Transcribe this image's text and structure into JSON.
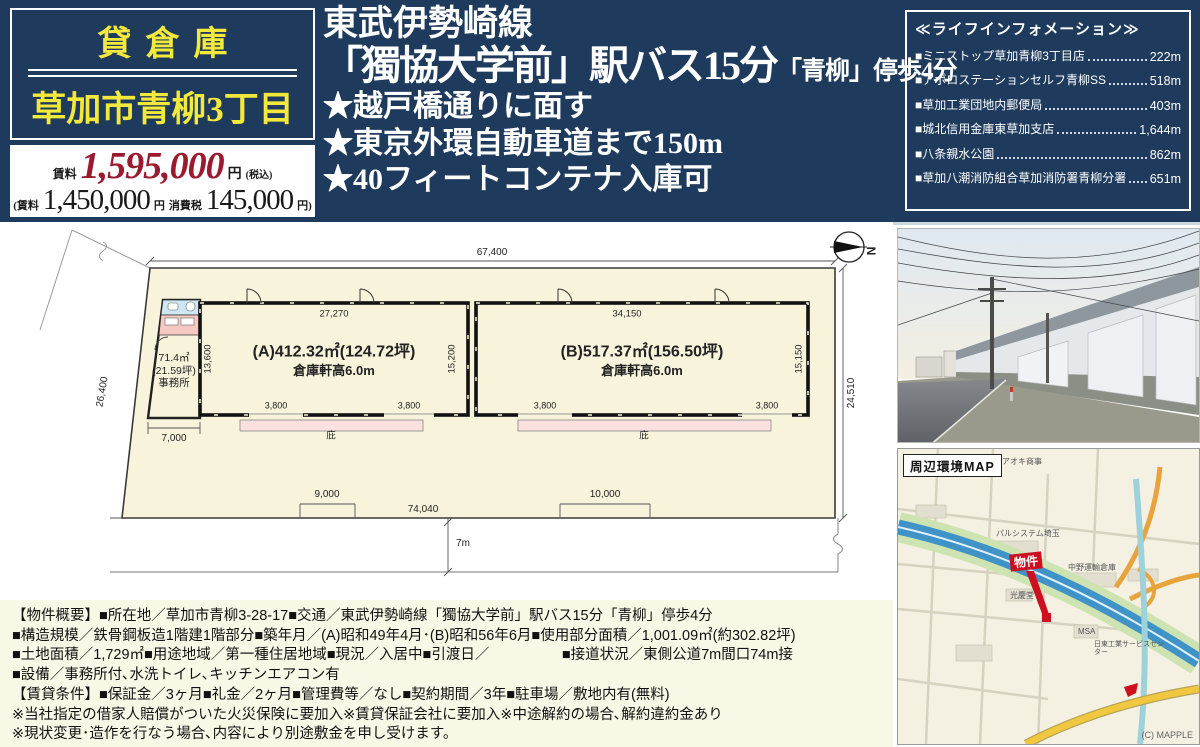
{
  "header": {
    "badge": "貸倉庫",
    "title": "草加市青柳3丁目",
    "price": {
      "label": "賃料",
      "amount": "1,595,000",
      "unit": "円",
      "tax_note": "(税込)",
      "detail_open": "(賃料",
      "base": "1,450,000",
      "base_unit": "円",
      "tax_label": "消費税",
      "tax": "145,000",
      "tax_unit": "円)"
    },
    "line1": "東武伊勢崎線",
    "line2_main": "「獨協大学前」駅バス15分",
    "line2_sub": "「青柳」停歩4分",
    "features": [
      "★越戸橋通りに面す",
      "★東京外環自動車道まで150m",
      "★40フィートコンテナ入庫可"
    ]
  },
  "lifeinfo": {
    "title": "≪ライフインフォメーション≫",
    "items": [
      {
        "label": "■ミニストップ草加青柳3丁目店",
        "distance": "222m"
      },
      {
        "label": "■アポロステーションセルフ青柳SS",
        "distance": "518m"
      },
      {
        "label": "■草加工業団地内郵便局",
        "distance": "403m"
      },
      {
        "label": "■城北信用金庫東草加支店",
        "distance": "1,644m"
      },
      {
        "label": "■八条親水公園",
        "distance": "862m"
      },
      {
        "label": "■草加八潮消防組合草加消防署青柳分署",
        "distance": "651m"
      }
    ]
  },
  "plan": {
    "dims": {
      "top": "67,400",
      "left": "26,400",
      "right": "24,510",
      "bottom": "74,040",
      "nine": "9,000",
      "ten": "10,000",
      "seven_k": "7,000",
      "road": "7m"
    },
    "office": {
      "area": "71.4㎡",
      "tsubo": "(21.59坪)",
      "name": "事務所"
    },
    "a": {
      "dim_top": "27,270",
      "dim_left": "13,600",
      "dim_right": "15,200",
      "door1": "3,800",
      "door2": "3,800",
      "title": "(A)412.32㎡(124.72坪)",
      "sub": "倉庫軒高6.0m",
      "canopy": "庇"
    },
    "b": {
      "dim_top": "34,150",
      "dim_right": "15,150",
      "door1": "3,800",
      "door2": "3,800",
      "title": "(B)517.37㎡(156.50坪)",
      "sub": "倉庫軒高6.0m",
      "canopy": "庇"
    },
    "north": "N"
  },
  "map": {
    "title": "周辺環境MAP",
    "marker": "物件",
    "credit": "(C) MAPPLE",
    "labels": {
      "aoki": "アオキ商事",
      "palsystem": "パルシステム埼玉",
      "nakano": "中野運輸倉庫",
      "kokeido": "光慶堂",
      "msa": "MSA",
      "nitto": "日東工業サービスセンター"
    }
  },
  "overview": {
    "lines": [
      "【物件概要】■所在地／草加市青柳3-28-17■交通／東武伊勢崎線「獨協大学前」駅バス15分「青柳」停歩4分",
      "■構造規模／鉄骨鋼板造1階建1階部分■築年月／(A)昭和49年4月･(B)昭和56年6月■使用部分面積／1,001.09㎡(約302.82坪)",
      "■土地面積／1,729㎡■用途地域／第一種住居地域■現況／入居中■引渡日／　　　　　■接道状況／東側公道7m間口74m接",
      "■設備／事務所付､水洗トイレ､キッチンエアコン有",
      "【賃貸条件】■保証金／3ヶ月■礼金／2ヶ月■管理費等／なし■契約期間／3年■駐車場／敷地内有(無料)",
      "※当社指定の借家人賠償がついた火災保険に要加入※賃貸保証会社に要加入※中途解約の場合､解約違約金あり",
      "※現状変更･造作を行なう場合､内容により別途敷金を申し受けます。"
    ]
  }
}
